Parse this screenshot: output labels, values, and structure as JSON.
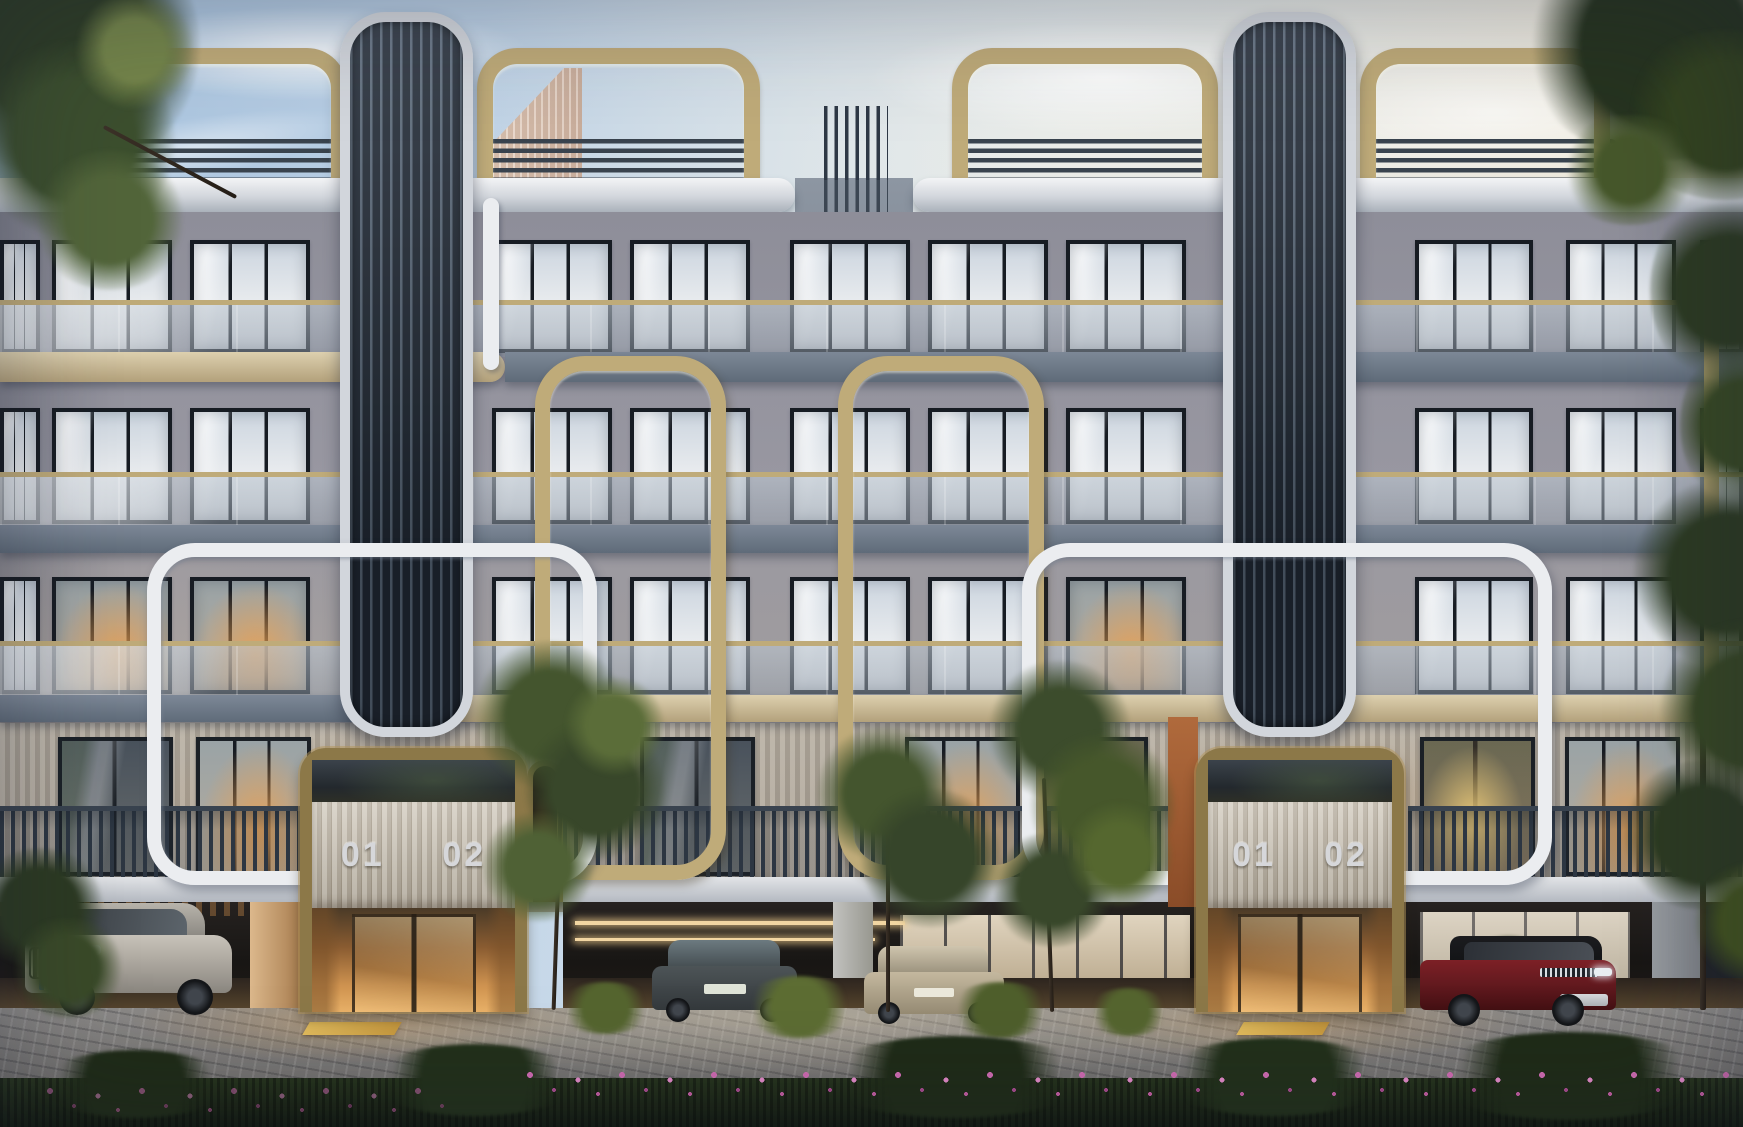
{
  "scene_title": "Modern residential apartment building exterior render at dusk",
  "entrances": [
    {
      "name": "left-entrance",
      "unit_labels": [
        "01",
        "02"
      ]
    },
    {
      "name": "right-entrance",
      "unit_labels": [
        "01",
        "02"
      ]
    }
  ],
  "building": {
    "floors_above_ground": 4,
    "ground_level": "open stilt parking with warm lighting",
    "features": [
      "dark vertical-louver towers",
      "gold tube frames",
      "white tube frames",
      "glass balconies with gold handrails",
      "rooftop gold pergola frames",
      "horizontal roof louvers",
      "ribbed entrance canopies"
    ]
  },
  "vehicles": [
    {
      "type": "suv",
      "color_name": "silver",
      "hex": "#b9b3a9",
      "position": "left garage, front three-quarter view"
    },
    {
      "type": "sedan",
      "color_name": "dark grey",
      "hex": "#454c4f",
      "position": "center garage left, rear view"
    },
    {
      "type": "sedan",
      "color_name": "champagne",
      "hex": "#bdb198",
      "position": "center garage right, rear view"
    },
    {
      "type": "suv",
      "color_name": "dark red",
      "hex": "#73191f",
      "position": "right garage, front three-quarter view"
    },
    {
      "type": "suv",
      "color_name": "black",
      "hex": "#22262b",
      "position": "far right edge of garage"
    }
  ],
  "vegetation": {
    "overhanging_trees": [
      "top-left canopy",
      "top-right canopy",
      "right-edge tree"
    ],
    "foreground": [
      "three small trees in front of garage",
      "left shrub",
      "grass tufts",
      "full-width hedge with pink flowers"
    ]
  },
  "palette": {
    "sky_top": "#a6c2de",
    "sky_warm": "#f1e8d6",
    "facade": "#98979f",
    "slab_gray": "#68embedded7482",
    "cream": "#d2c5a3",
    "gold": "#bfab79",
    "gold_dark": "#8c7848",
    "white_tube": "#ebedf0",
    "tower_dark": "#222b37",
    "tower_frame": "#d2d6dc",
    "window_frame": "#171c23",
    "rail_dark": "#2f3945",
    "lobby_glow": "#cf9350",
    "ribbed_panel": "#c3bcb0",
    "cobble": "#8b8987",
    "hedge_green": "#1f2a19",
    "flower_pink": "#d06cb2",
    "leaf_dark": "#2c3a24",
    "leaf_mid": "#4f6234",
    "leaf_light": "#7a8c4c"
  }
}
